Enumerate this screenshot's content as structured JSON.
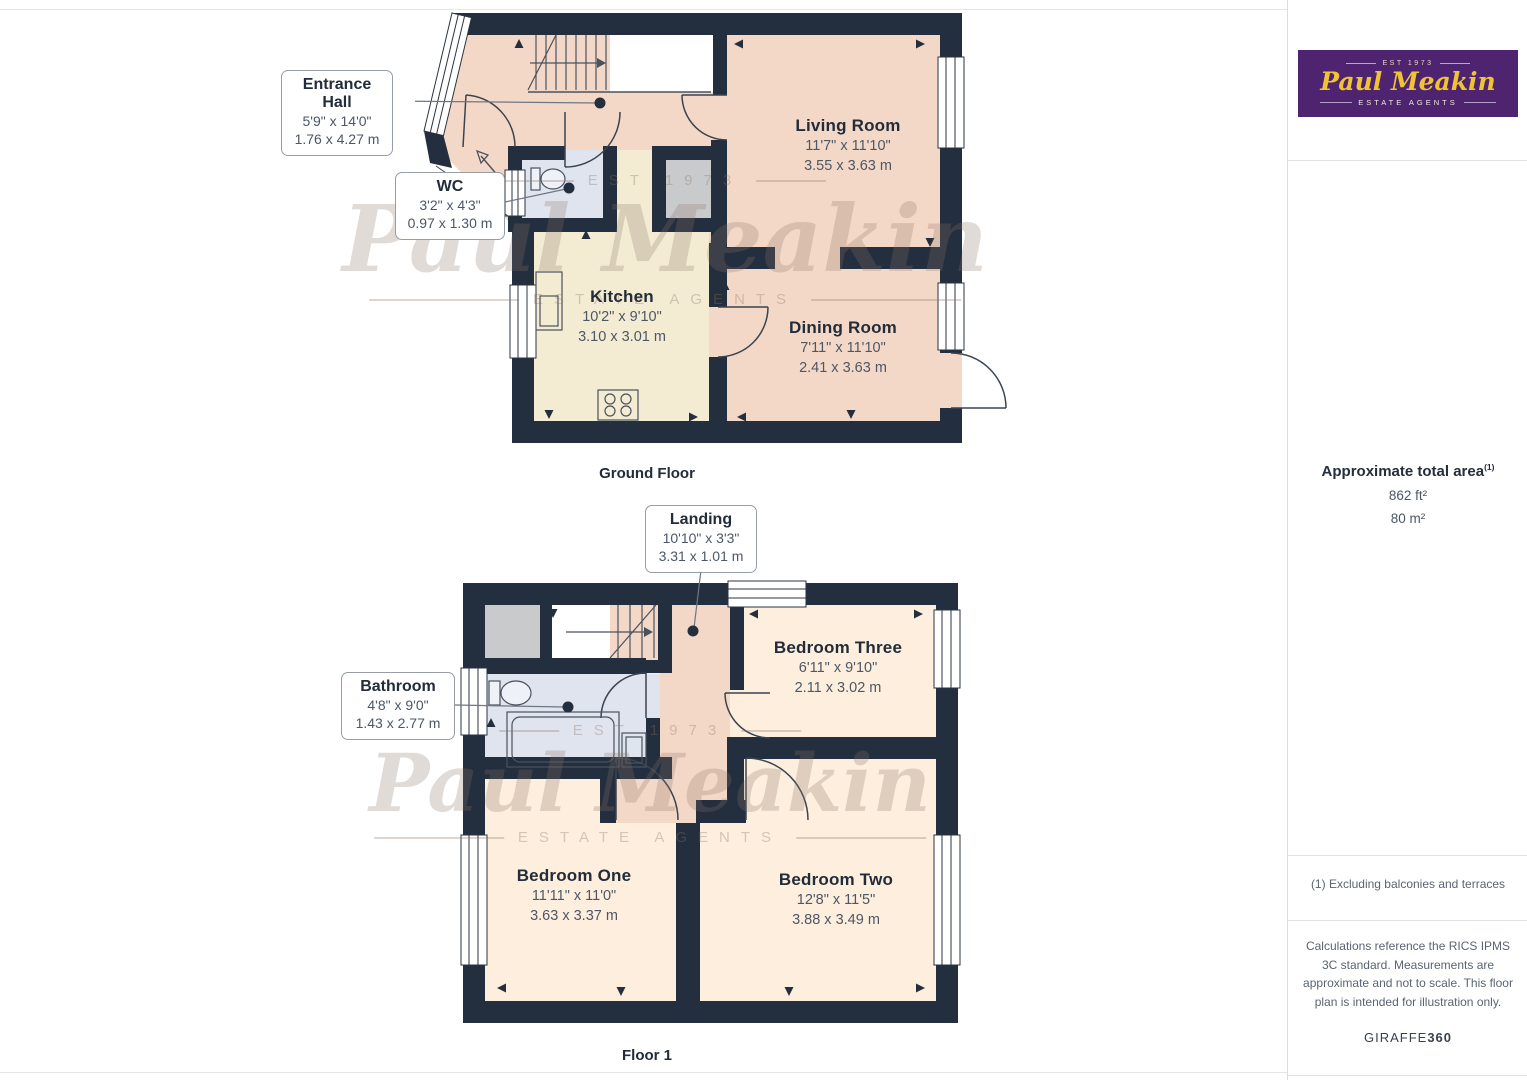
{
  "ground_floor": {
    "caption": "Ground Floor",
    "rooms": {
      "living": {
        "name": "Living Room",
        "imperial": "11'7\" x 11'10\"",
        "metric": "3.55 x 3.63 m"
      },
      "kitchen": {
        "name": "Kitchen",
        "imperial": "10'2\" x 9'10\"",
        "metric": "3.10 x 3.01 m"
      },
      "dining": {
        "name": "Dining Room",
        "imperial": "7'11\" x 11'10\"",
        "metric": "2.41 x 3.63 m"
      }
    },
    "callouts": {
      "entrance": {
        "name": "Entrance Hall",
        "imperial": "5'9\" x 14'0\"",
        "metric": "1.76 x 4.27 m"
      },
      "wc": {
        "name": "WC",
        "imperial": "3'2\" x 4'3\"",
        "metric": "0.97 x 1.30 m"
      }
    }
  },
  "floor_one": {
    "caption": "Floor 1",
    "rooms": {
      "bedroom_three": {
        "name": "Bedroom Three",
        "imperial": "6'11\" x 9'10\"",
        "metric": "2.11 x 3.02 m"
      },
      "bedroom_one": {
        "name": "Bedroom One",
        "imperial": "11'11\" x 11'0\"",
        "metric": "3.63 x 3.37 m"
      },
      "bedroom_two": {
        "name": "Bedroom Two",
        "imperial": "12'8\" x 11'5\"",
        "metric": "3.88 x 3.49 m"
      }
    },
    "callouts": {
      "landing": {
        "name": "Landing",
        "imperial": "10'10\" x 3'3\"",
        "metric": "3.31 x 1.01 m"
      },
      "bathroom": {
        "name": "Bathroom",
        "imperial": "4'8\" x 9'0\"",
        "metric": "1.43 x 2.77 m"
      }
    }
  },
  "watermark": {
    "est": "EST 1973",
    "name": "Paul Meakin",
    "agents": "ESTATE AGENTS"
  },
  "sidebar": {
    "logo": {
      "est": "EST 1973",
      "name": "Paul Meakin",
      "tagline": "ESTATE AGENTS"
    },
    "area": {
      "title": "Approximate total area",
      "footnote_mark": "(1)",
      "imperial": "862 ft²",
      "metric": "80 m²"
    },
    "footnote": "(1) Excluding balconies and terraces",
    "disclaimer": "Calculations reference the RICS IPMS 3C standard. Measurements are approximate and not to scale. This floor plan is intended for illustration only.",
    "brand": {
      "name": "GIRAFFE",
      "suffix": "360"
    }
  },
  "colors": {
    "wall": "#232e3e",
    "hall": "#f4d8c7",
    "kitchen": "#f3ecd3",
    "wet_room": "#dfe4ef",
    "bedroom": "#fdeedd",
    "storage": "#c9cacc",
    "logo_purple": "#4e2470",
    "logo_gold": "#f0c335"
  }
}
